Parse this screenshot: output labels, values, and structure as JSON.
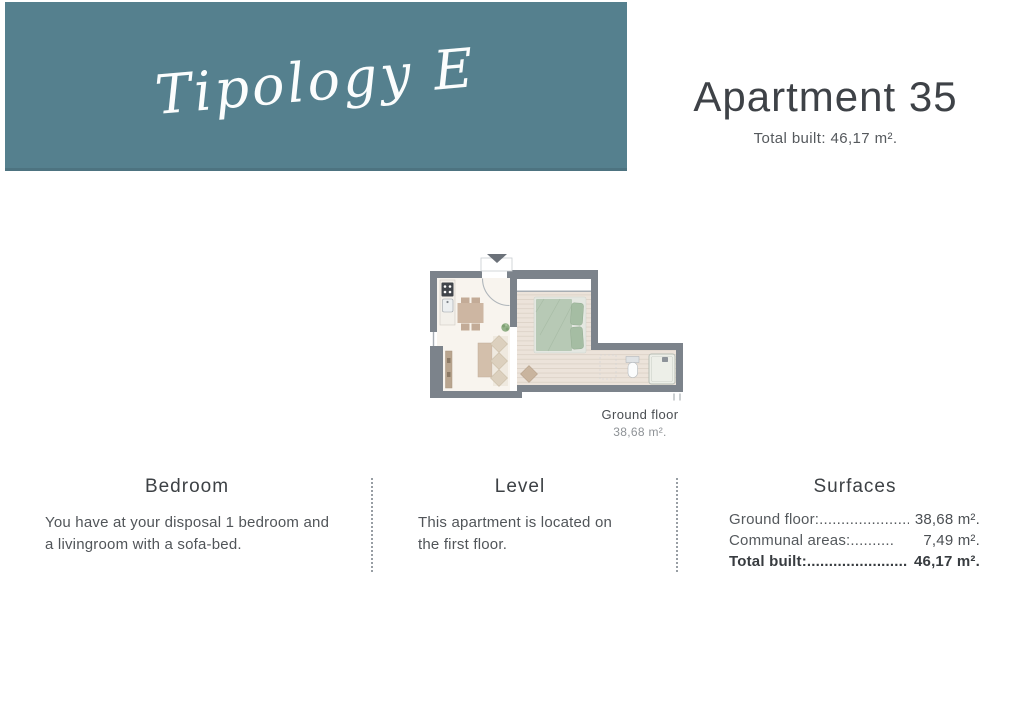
{
  "theme": {
    "teal": "#55808e",
    "wall": "#7c838b",
    "floor_living": "#f8f4ee",
    "floor_wood": "#ece3da",
    "wood_line": "#ddd3c8",
    "bed": "#b7c9b5",
    "pillow": "#a5bda3",
    "tan": "#cdb6a2",
    "sofa": "#dcd0be",
    "plant": "#93b188",
    "text_dark": "#3e4247",
    "text_mid": "#55595d",
    "text_light": "#8e9296"
  },
  "banner": {
    "title": "Tipology E"
  },
  "header": {
    "title": "Apartment 35",
    "subtitle": "Total built: 46,17 m²."
  },
  "floorplan": {
    "caption_title": "Ground floor",
    "caption_area": "38,68 m²."
  },
  "sections": [
    {
      "heading": "Bedroom",
      "lines": [
        "You have at your disposal 1 bedroom and",
        "a livingroom with a sofa-bed."
      ]
    },
    {
      "heading": "Level",
      "lines": [
        "This apartment is located on",
        "the first floor."
      ]
    },
    {
      "heading": "Surfaces",
      "rows": [
        {
          "label": "Ground floor:......................",
          "value": "38,68 m²."
        },
        {
          "label": "Communal areas:..........",
          "value": "7,49 m²."
        },
        {
          "label": "Total built:...........................",
          "value": "46,17 m²."
        }
      ]
    }
  ]
}
